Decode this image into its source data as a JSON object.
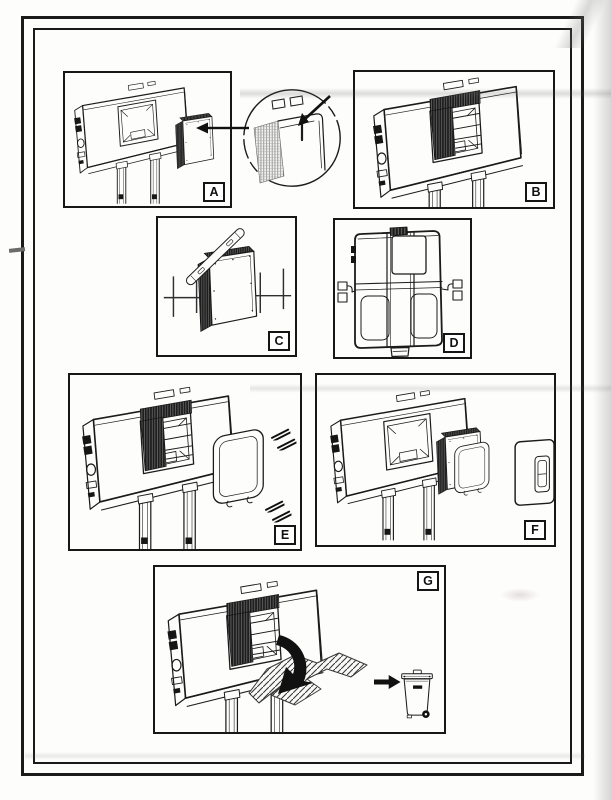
{
  "sheet": {
    "kind": "scanned-installation-instruction-sheet",
    "colors": {
      "ink": "#1b1b1b",
      "paper": "#fdfdfc",
      "foam_dark": "#1a1a1a",
      "scan_shadow": "#9a9a96"
    }
  },
  "panels": [
    {
      "letter": "A",
      "illustration": "cistern-iso-foam-block-with-magnified-corner-detail"
    },
    {
      "letter": "B",
      "illustration": "cistern-iso-foam-block-inserted"
    },
    {
      "letter": "C",
      "illustration": "foam-block-spirit-level-wall-cross-marks"
    },
    {
      "letter": "D",
      "illustration": "cistern-front-view-side-wall-brackets"
    },
    {
      "letter": "E",
      "illustration": "cistern-iso-mounting-frame-four-screws"
    },
    {
      "letter": "F",
      "illustration": "cistern-iso-foam-block-seal-frame-flush-plate"
    },
    {
      "letter": "G",
      "illustration": "remove-protection-piece-to-waste-bin"
    }
  ]
}
